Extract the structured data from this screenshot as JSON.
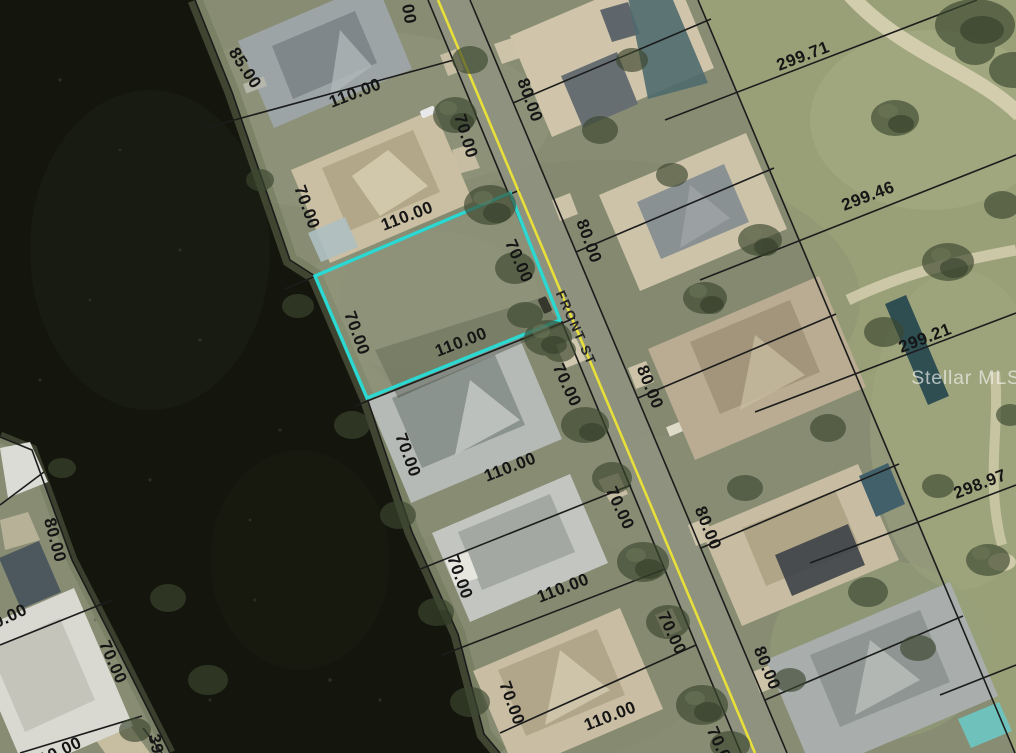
{
  "map": {
    "watermark": "Stellar MLS",
    "street_name": "FRONT ST",
    "colors": {
      "highlight": "#2bd8d2",
      "road_line": "#e8df3a",
      "parcel_line": "#1c1c1c",
      "water": "#14160e",
      "label_text": "#151515"
    },
    "dimension_labels": [
      {
        "text": "85.00"
      },
      {
        "text": "110.00"
      },
      {
        "text": "70.00"
      },
      {
        "text": "00"
      },
      {
        "text": "80.00"
      },
      {
        "text": "299.71"
      },
      {
        "text": "299.46"
      },
      {
        "text": "70.00"
      },
      {
        "text": "110.00"
      },
      {
        "text": "70.00"
      },
      {
        "text": "80.00"
      },
      {
        "text": "70.00"
      },
      {
        "text": "110.00"
      },
      {
        "text": "299.21"
      },
      {
        "text": "70.00"
      },
      {
        "text": "80.00"
      },
      {
        "text": "70.00"
      },
      {
        "text": "110.00"
      },
      {
        "text": "298.97"
      },
      {
        "text": "70.00"
      },
      {
        "text": "80.00"
      },
      {
        "text": "80.00"
      },
      {
        "text": "70.00"
      },
      {
        "text": "110.00"
      },
      {
        "text": "0.00"
      },
      {
        "text": "70.00"
      },
      {
        "text": "80.00"
      },
      {
        "text": "70.00"
      },
      {
        "text": "70.00"
      },
      {
        "text": "110.00"
      },
      {
        "text": "39"
      },
      {
        "text": "10.00"
      },
      {
        "text": "70.00"
      }
    ]
  }
}
